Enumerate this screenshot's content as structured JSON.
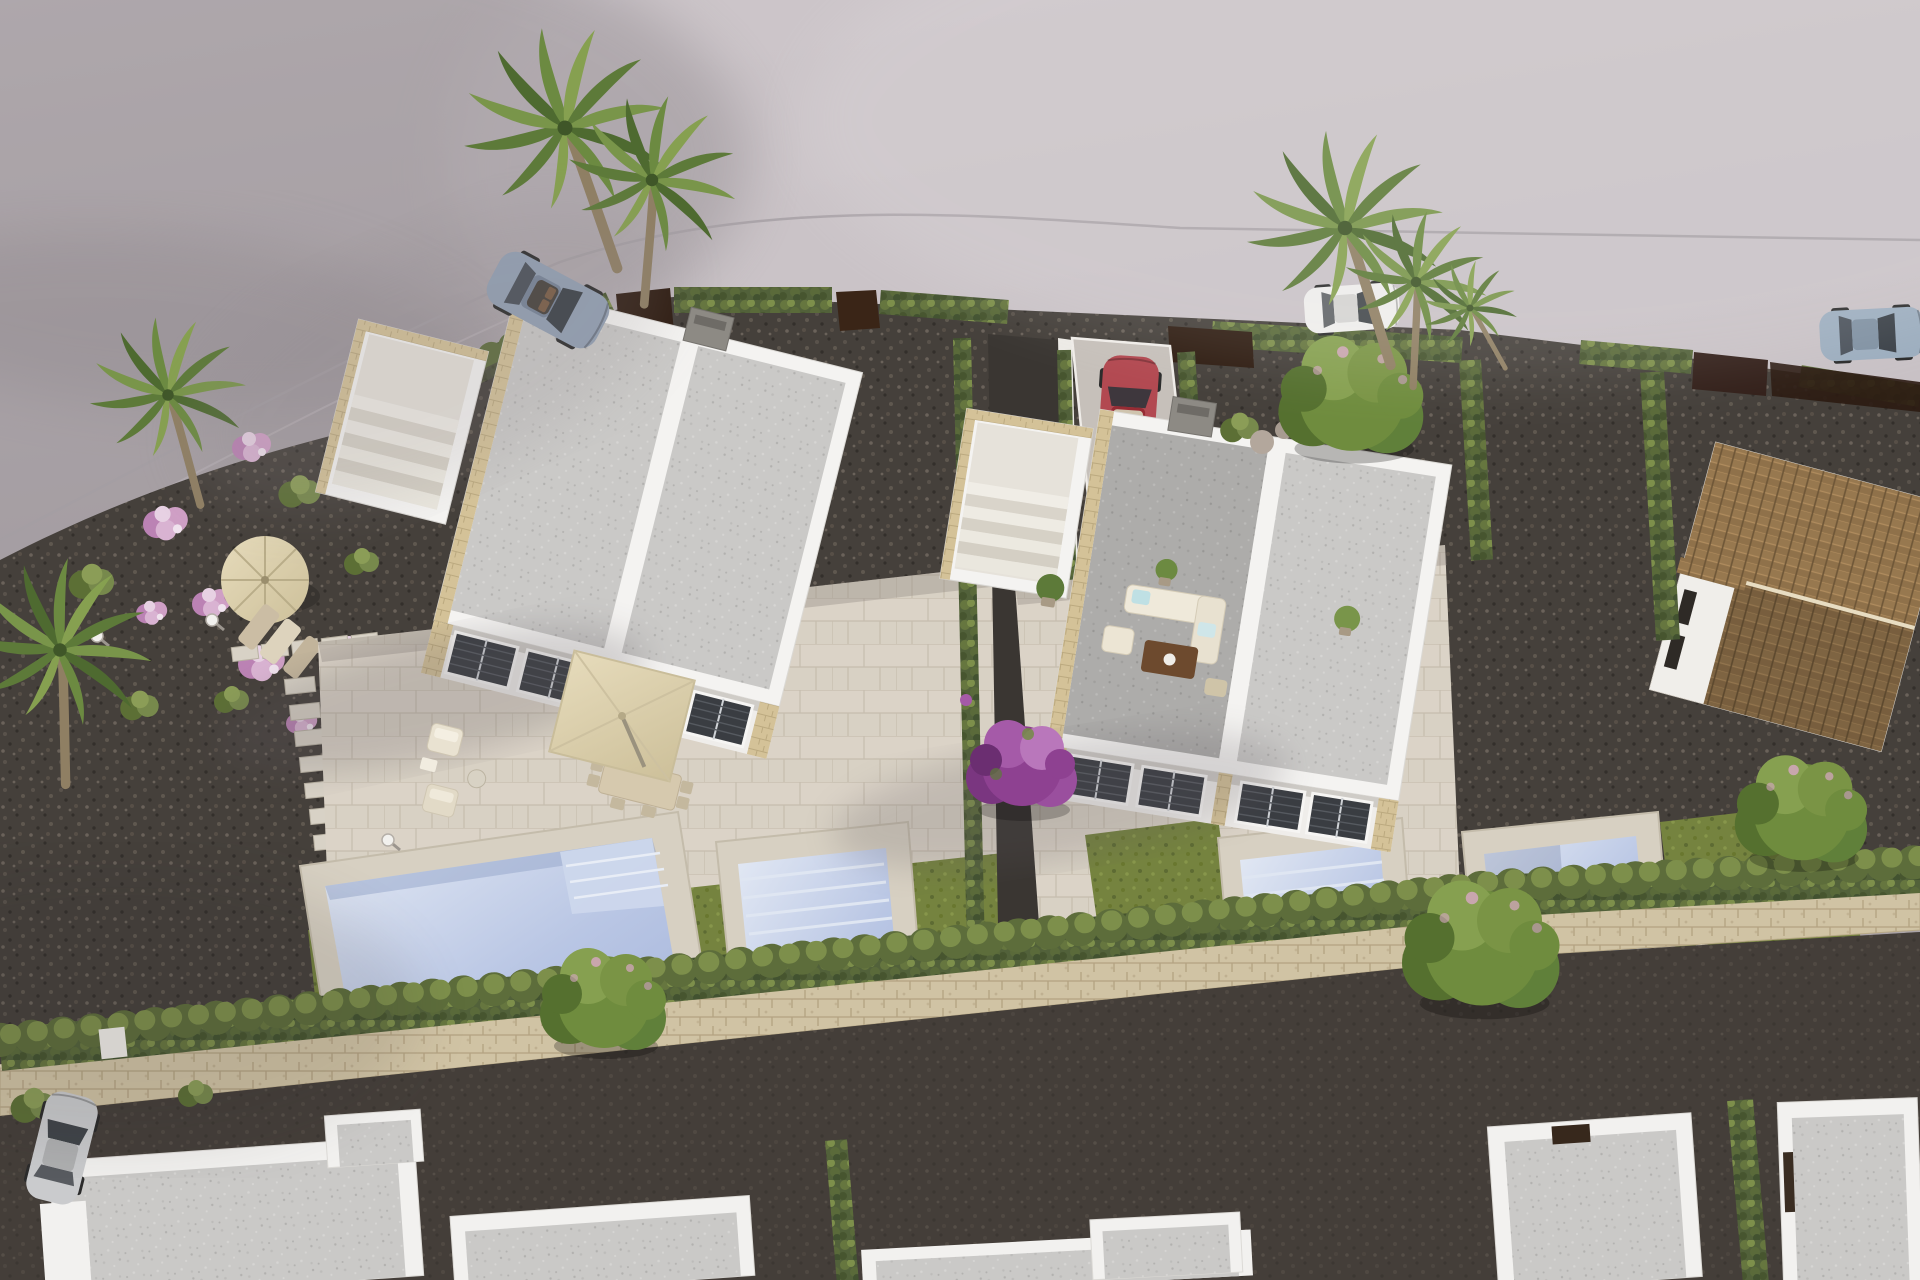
{
  "meta": {
    "title": "Aerial 3D architectural render of a modern villa development",
    "type": "photorealistic-visualization",
    "setting": "daytime aerial view, two semi-detached white villas with private pools, gardens, parked cars, neighbouring houses"
  },
  "palette": {
    "bg_top": "#c8c1c5",
    "bg_mid": "#b4adb1",
    "bg_low": "#a8a1a5",
    "shadow": "#8f888d",
    "curb": "#a49da2",
    "gravel": "#45403b",
    "road_dark": "#433d38",
    "hedge": "#52613a",
    "hedge_light": "#7d8f4b",
    "grass": "#75833f",
    "roof": "#cac9c7",
    "roof_dark": "#adacaa",
    "wall": "#f4f3f1",
    "wall_shade": "#dcdad6",
    "stone": "#d4c298",
    "deck": "#d7d0c2",
    "pavers": "#d8d1c4",
    "pool_hi": "#e3e9f4",
    "pool_mid": "#b9c6e4",
    "pool_lo": "#a3b3da",
    "parasol_hi": "#e6dbbb",
    "parasol_lo": "#cdc09a",
    "gate_brown": "#2f1d12",
    "tile_roof": "#97784f",
    "wall_blocks": "#d0c3a4",
    "tree_green": "#6f8c3e",
    "tree_purple": "#8e4191",
    "flower_pink": "#cf9fc5",
    "chimney": "#8d8a84",
    "car_red": "#a83039",
    "car_blue": "#8494aa",
    "car_white": "#ecebe9",
    "car_suv": "#8fa2b5",
    "car_silver": "#c3c4c6",
    "furniture_cream": "#e9e2d1",
    "pergola_brown": "#6d4a2e"
  },
  "scene": {
    "villas": [
      {
        "name": "left semi-detached villa",
        "features": [
          "two grey flat roofs",
          "roof terrace with staircase",
          "stone trim",
          "front patio with square parasol and dining set",
          "large square pool",
          "narrow pool",
          "lawn"
        ]
      },
      {
        "name": "right semi-detached villa",
        "features": [
          "two grey flat roofs",
          "roof terrace with staircase",
          "stone trim",
          "patio with lounge sofas",
          "two rectangular pools",
          "lawns"
        ]
      }
    ],
    "vehicles": [
      {
        "name": "blue convertible",
        "location": "top road"
      },
      {
        "name": "red compact car",
        "location": "driveway between villas"
      },
      {
        "name": "white sedan",
        "location": "top right road"
      },
      {
        "name": "blue-grey suv",
        "location": "far right road"
      },
      {
        "name": "silver hatchback",
        "location": "bottom left lane"
      }
    ],
    "landscape": [
      "palm trees",
      "cypress hedges",
      "pink flowering shrubs",
      "purple bougainvillea tree",
      "green fruit trees",
      "stepping stone paths",
      "stone boundary wall",
      "dark gravel beds"
    ],
    "neighbouring": [
      "terracotta tiled roof house on the right",
      "five white flat-roof houses along the bottom",
      "brown timber gates along the street"
    ]
  }
}
